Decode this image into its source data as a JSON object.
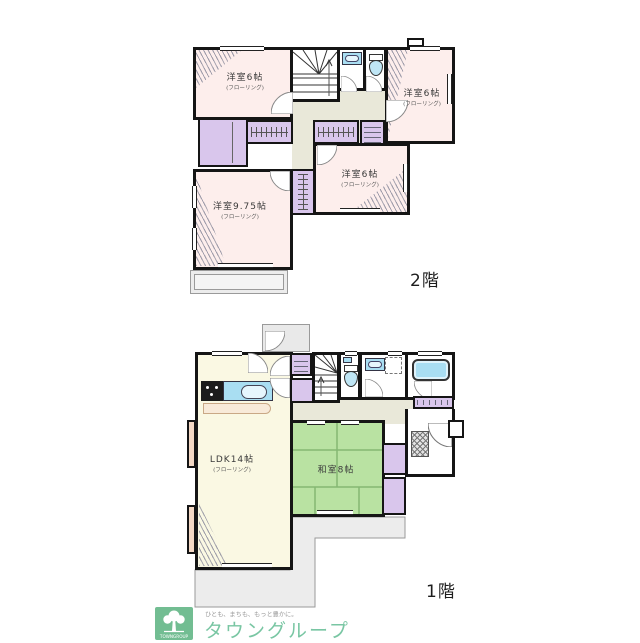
{
  "palette": {
    "wall": "#151515",
    "room_pink": "#fdeeec",
    "ldk_cream": "#faf8e3",
    "tatami_green": "#b9e2a2",
    "closet_purple": "#d9c6ec",
    "hall_olive": "#e9e8d9",
    "fixture_cyan": "#a9def2",
    "bay_window_tan": "#f3d8c4",
    "outline_gray": "#ececec",
    "brand_green": "#79c6a3"
  },
  "floor2": {
    "floor_label": "2階",
    "rooms": {
      "nw": {
        "label": "洋室6帖",
        "sub": "(フローリング)"
      },
      "ne": {
        "label": "洋室6帖",
        "sub": "(フローリング)"
      },
      "mid": {
        "label": "洋室6帖",
        "sub": "(フローリング)"
      },
      "sw": {
        "label": "洋室9.75帖",
        "sub": "(フローリング)"
      }
    }
  },
  "floor1": {
    "floor_label": "1階",
    "rooms": {
      "ldk": {
        "label": "LDK14帖",
        "sub": "(フローリング)"
      },
      "washitsu": {
        "label": "和室8帖"
      }
    }
  },
  "logo": {
    "mark_text": "TOWNGROUP",
    "tagline": "ひとも、まちも、もっと豊かに。",
    "brand": "タウングループ"
  }
}
